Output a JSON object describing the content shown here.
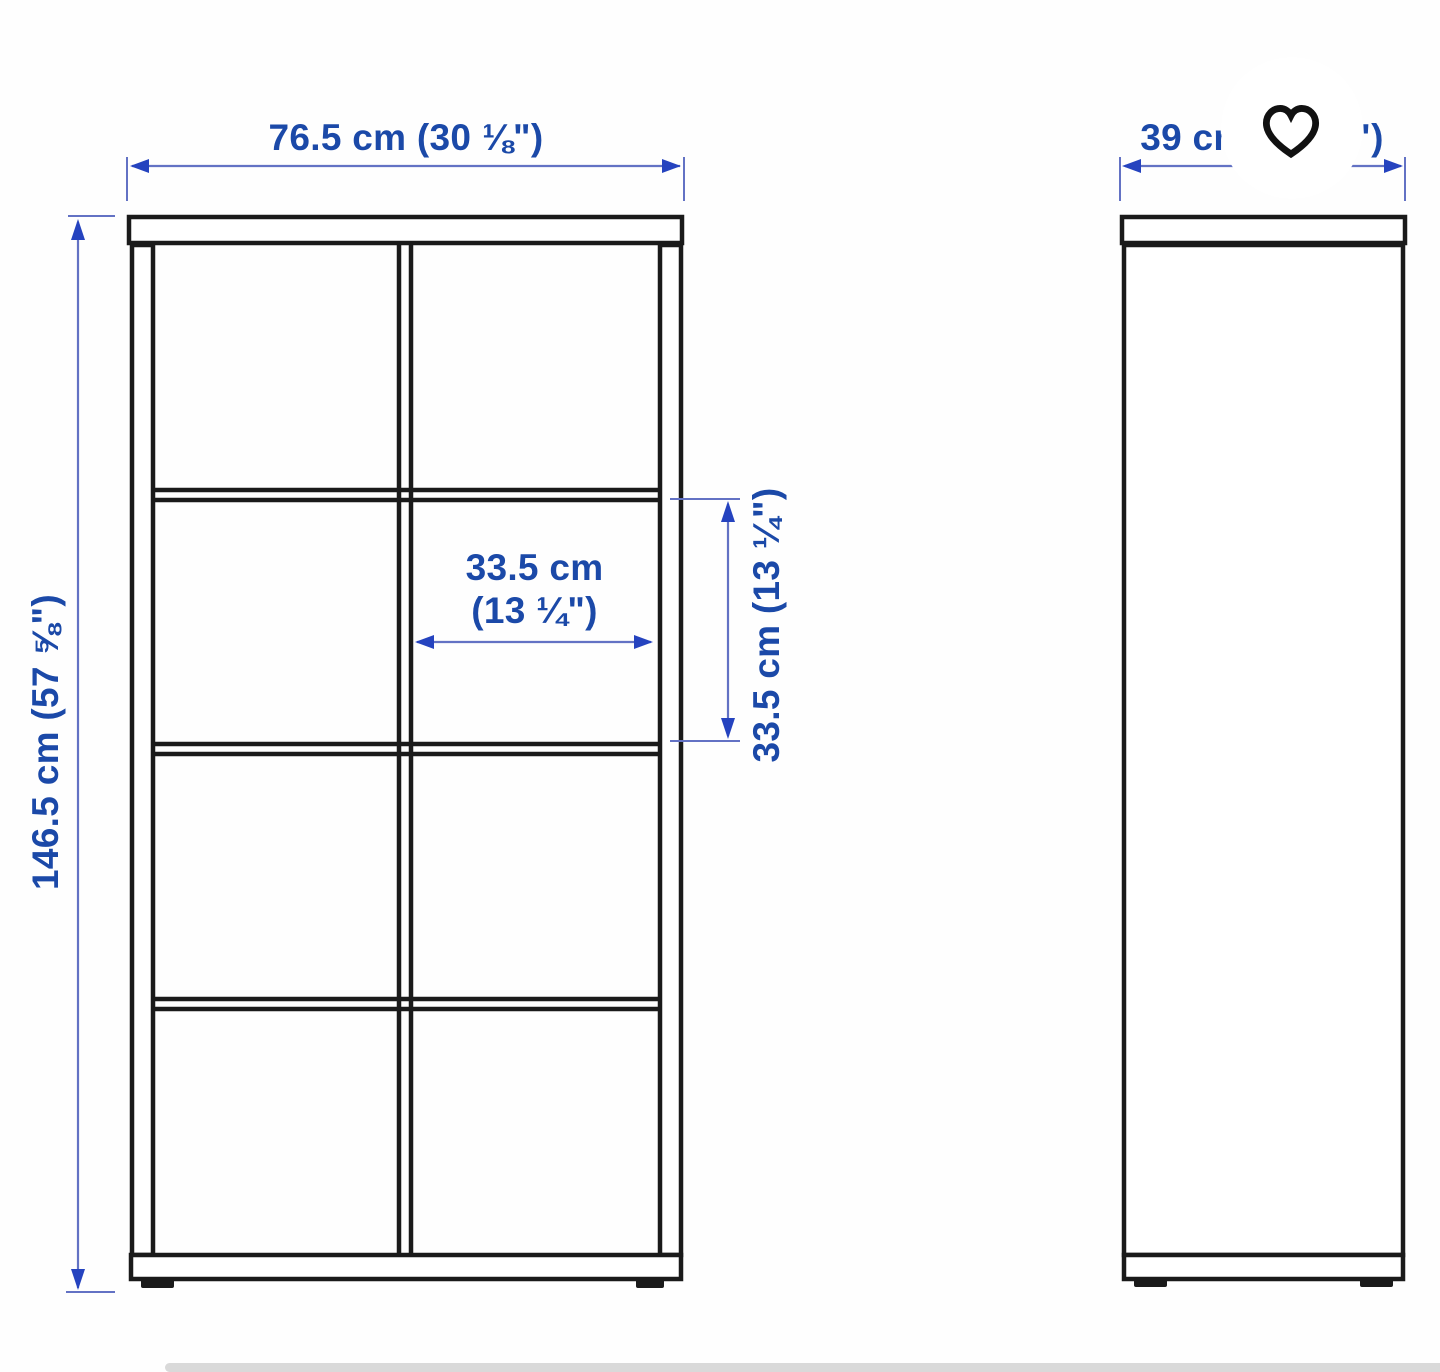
{
  "labels": {
    "overall_width": "76.5 cm (30 ⅛\")",
    "overall_height": "146.5 cm (57 ⅝\")",
    "inner_width_line1": "33.5 cm",
    "inner_width_line2": "(13 ¼\")",
    "inner_height": "33.5 cm (13 ¼\")",
    "depth": "39 cm (15 ⅜\")"
  },
  "icons": {
    "favorite": "heart-icon"
  },
  "colors": {
    "dimension_text": "#1b49a8",
    "dimension_line": "#6372c4",
    "arrow": "#2543bf",
    "outline": "#1a1a1a",
    "heart": "#111111",
    "strip": "#d9d9d9"
  }
}
